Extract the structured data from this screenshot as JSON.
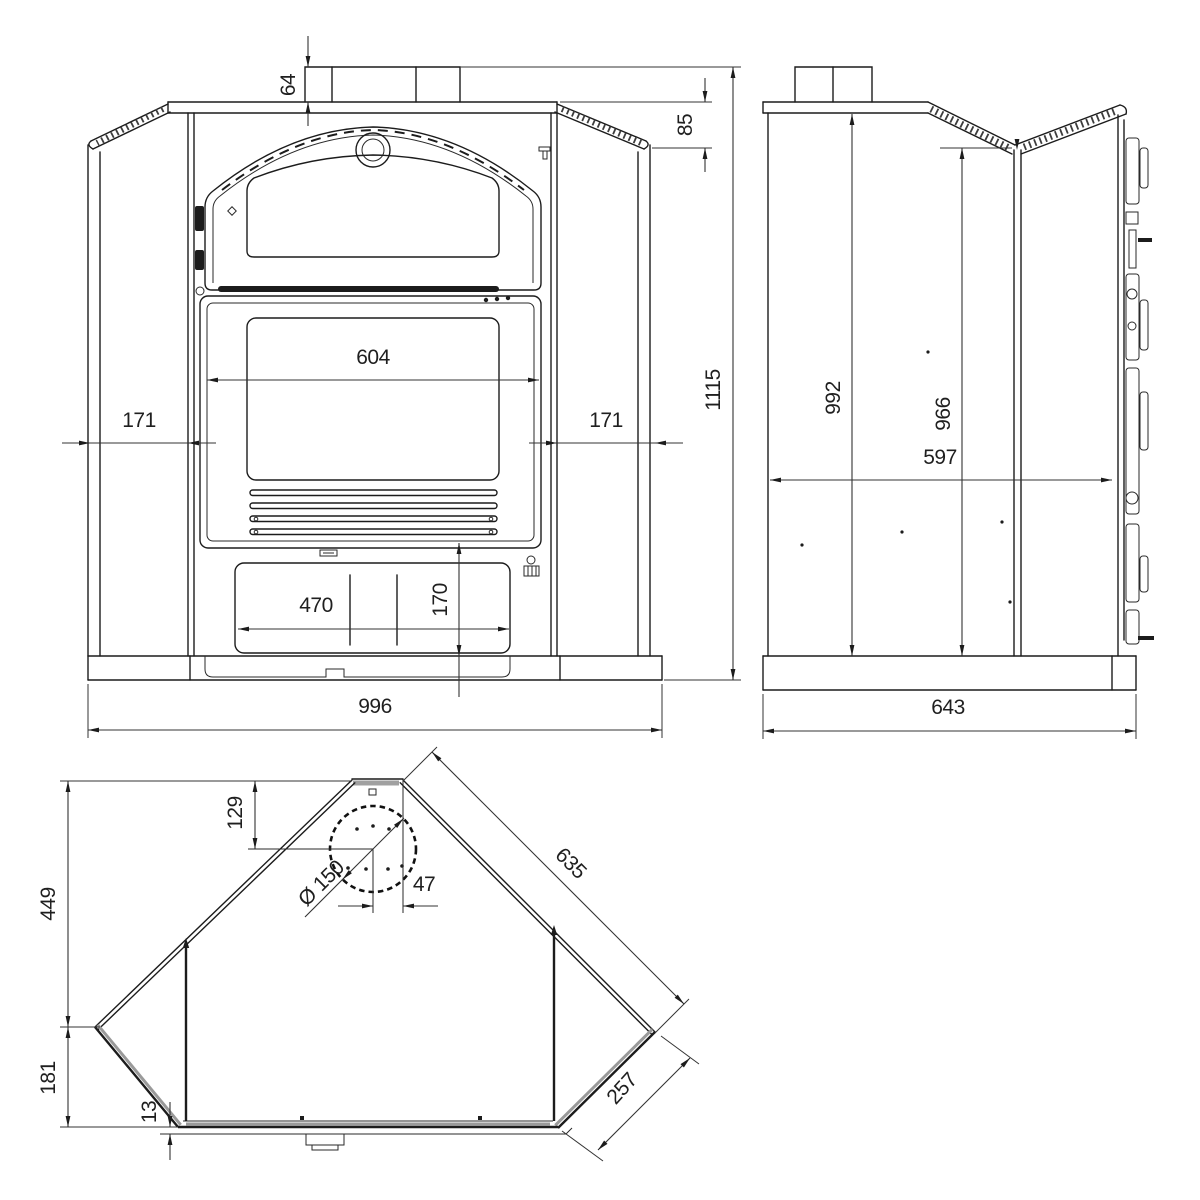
{
  "drawing": {
    "units": "mm",
    "dims": {
      "front": {
        "flue_collar_height": "64",
        "plate_to_shoulder": "85",
        "door_width": "604",
        "left_panel": "171",
        "right_panel": "171",
        "drawer_width": "470",
        "base_height": "170",
        "overall_width": "996",
        "overall_height": "1115"
      },
      "side": {
        "front_height": "992",
        "back_height": "966",
        "body_depth": "597",
        "overall_depth": "643"
      },
      "plan": {
        "back_section_depth": "449",
        "front_corner_depth": "181",
        "base_lip": "13",
        "flue_from_back": "129",
        "flue_diameter": "Ø 150",
        "flue_offset": "47",
        "back_edge": "635",
        "corner_edge": "257"
      }
    }
  }
}
